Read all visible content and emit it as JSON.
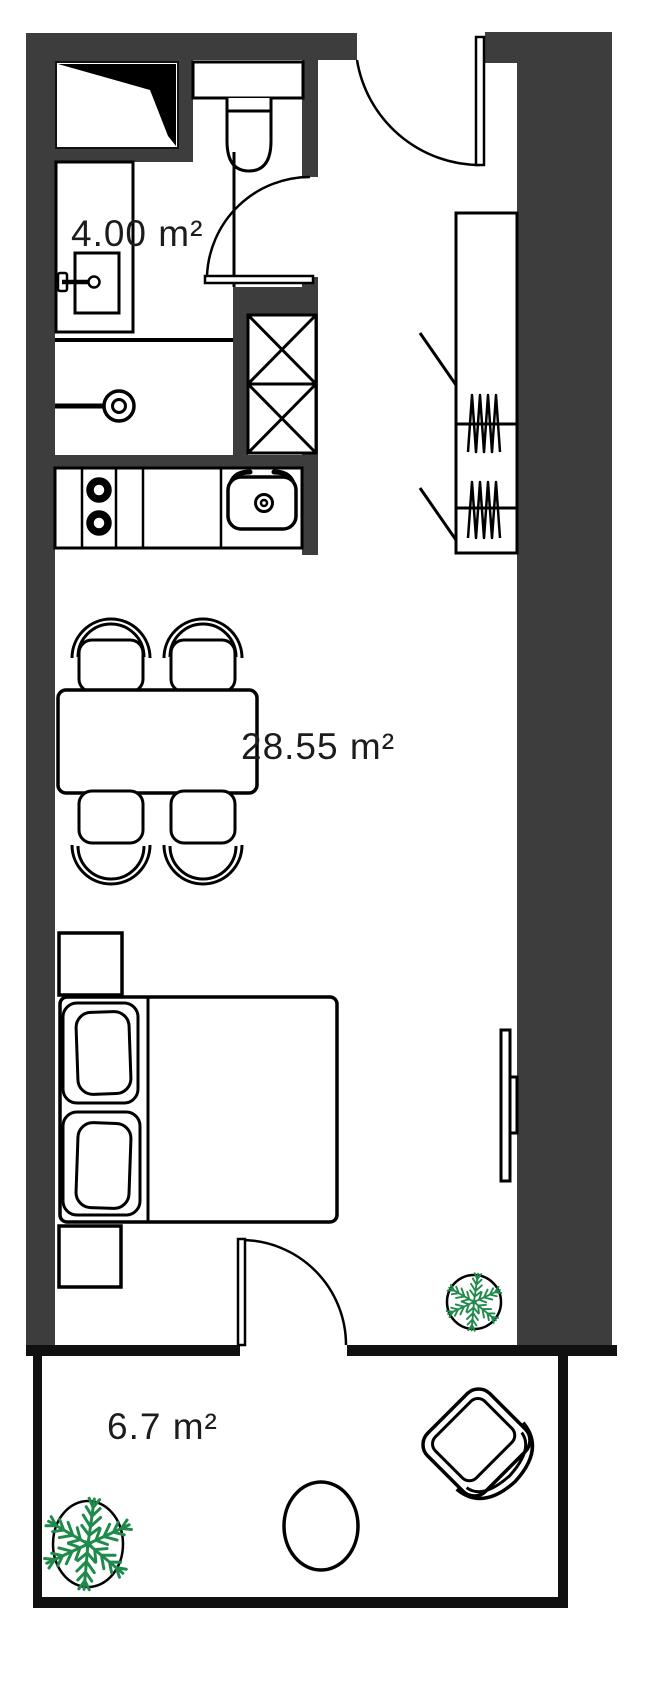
{
  "floorplan": {
    "rooms": [
      {
        "id": "bathroom",
        "area_label": "4.00 m²"
      },
      {
        "id": "living-room",
        "area_label": "28.55 m²"
      },
      {
        "id": "balcony",
        "area_label": "6.7 m²"
      }
    ],
    "fixtures": [
      "toilet",
      "washbasin-vanity",
      "faucet",
      "shower-drain",
      "ventilation-niche",
      "shaft-crossed-boxes",
      "kitchen-counter",
      "stove-two-burners",
      "kitchen-sink",
      "dining-table",
      "dining-chairs-x4",
      "double-bed",
      "pillows-x2",
      "nightstands-x2",
      "wardrobe-with-hangers",
      "wall-tv",
      "entrance-door",
      "bathroom-door",
      "balcony-door",
      "potted-plant-indoor",
      "potted-plant-balcony",
      "balcony-round-table",
      "balcony-armchair"
    ],
    "colors": {
      "wall": "#3d3d3d",
      "exterior_wall": "#101010",
      "line": "#000000",
      "plant": "#1f8a4c",
      "background": "#ffffff",
      "label_text": "#1c1c1c"
    }
  }
}
